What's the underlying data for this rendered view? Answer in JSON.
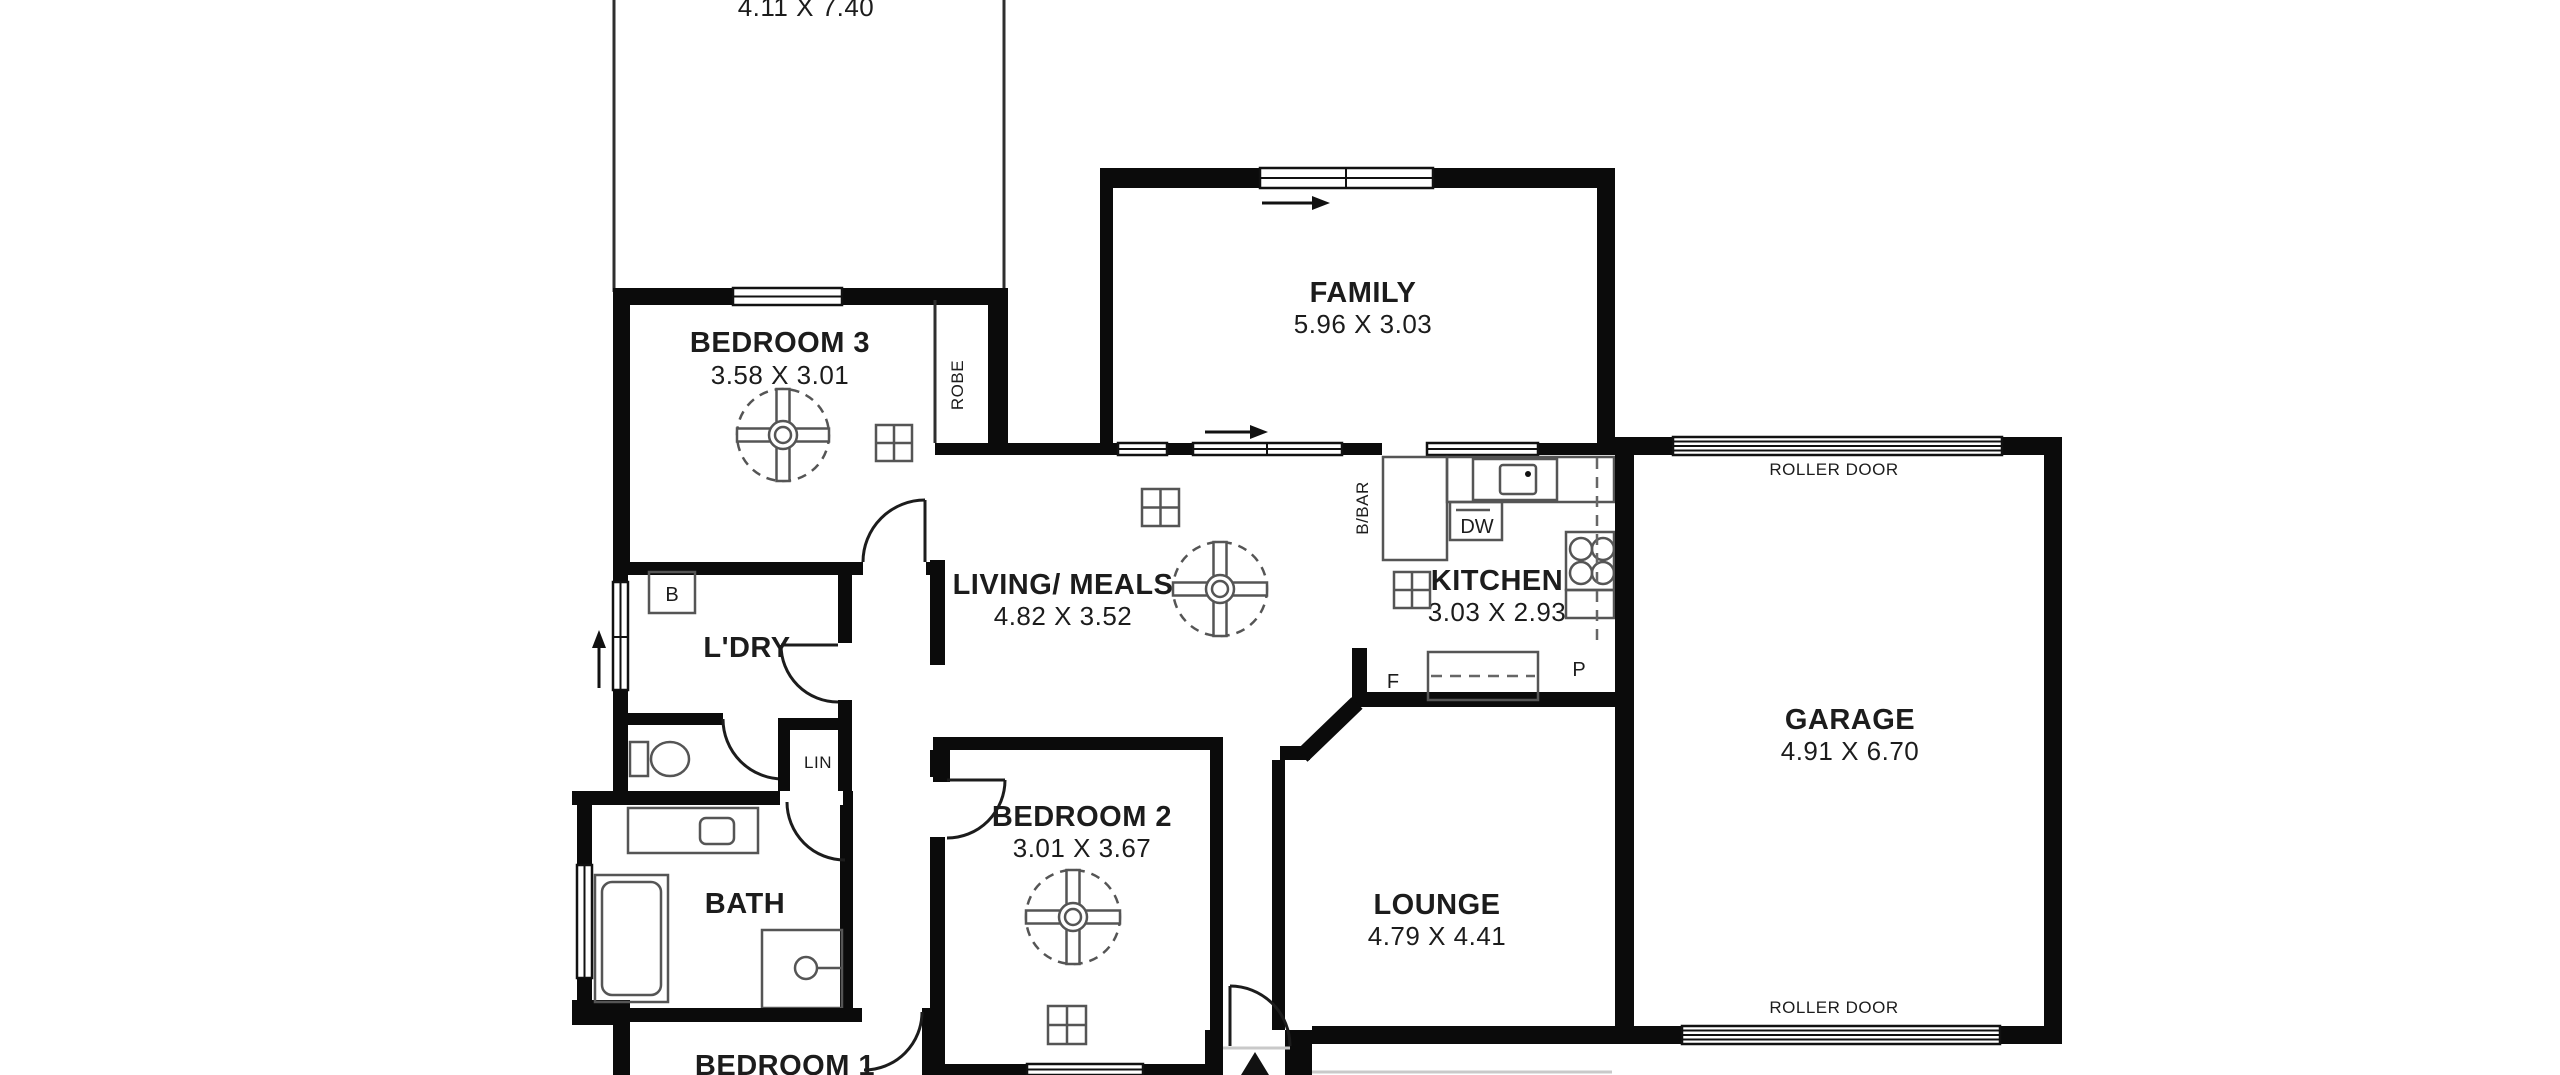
{
  "plan": {
    "rooms": {
      "carport": {
        "dims": "4.11 X 7.40"
      },
      "bedroom3": {
        "name": "BEDROOM 3",
        "dims": "3.58 X 3.01"
      },
      "family": {
        "name": "FAMILY",
        "dims": "5.96 X 3.03"
      },
      "living": {
        "name": "LIVING/ MEALS",
        "dims": "4.82 X 3.52"
      },
      "kitchen": {
        "name": "KITCHEN",
        "dims": "3.03 X 2.93"
      },
      "garage": {
        "name": "GARAGE",
        "dims": "4.91 X 6.70"
      },
      "laundry": {
        "name": "L'DRY"
      },
      "bath": {
        "name": "BATH"
      },
      "bedroom2": {
        "name": "BEDROOM 2",
        "dims": "3.01 X 3.67"
      },
      "lounge": {
        "name": "LOUNGE",
        "dims": "4.79 X 4.41"
      },
      "bedroom1": {
        "name": "BEDROOM 1"
      }
    },
    "labels": {
      "robe": "ROBE",
      "linen": "LIN",
      "breakfast_bar": "B/BAR",
      "dishwasher": "DW",
      "fridge": "F",
      "pantry": "P",
      "basin": "B",
      "roller_door_top": "ROLLER DOOR",
      "roller_door_bottom": "ROLLER DOOR"
    },
    "colors": {
      "wall": "#0b0b0b",
      "fixture_line": "#555555",
      "text": "#1c1c1c",
      "background": "#ffffff"
    }
  }
}
